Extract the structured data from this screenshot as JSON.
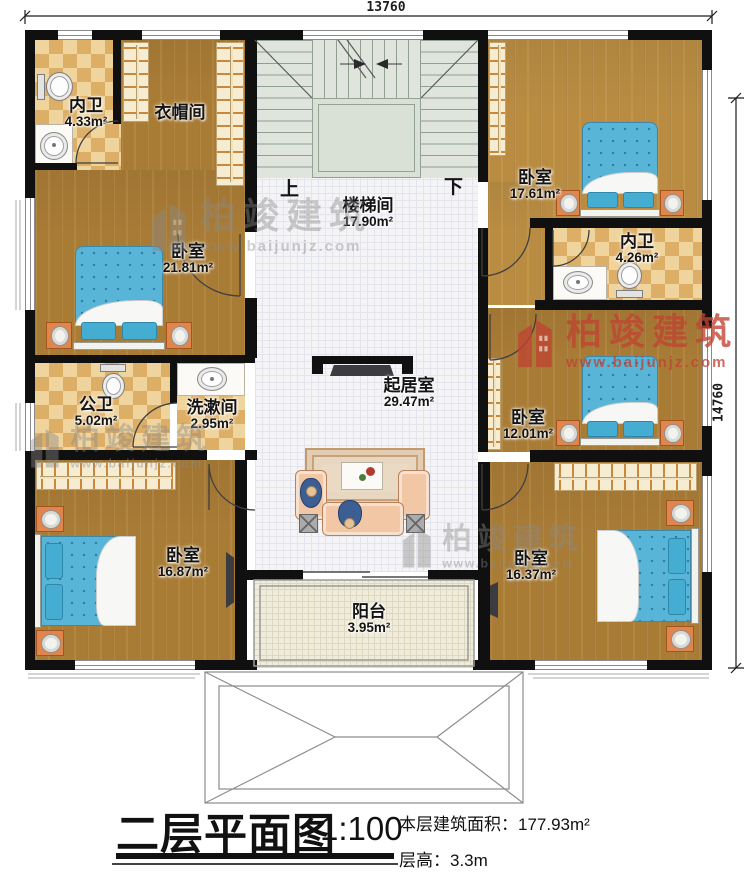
{
  "dimensions": {
    "top": "13760",
    "right": "14760"
  },
  "rooms": {
    "bath_tl": {
      "name": "内卫",
      "area": "4.33m²"
    },
    "cloakroom": {
      "name": "衣帽间"
    },
    "stair_hall": {
      "name": "楼梯间",
      "area": "17.90m²"
    },
    "bedroom_tr": {
      "name": "卧室",
      "area": "17.61m²"
    },
    "bath_r": {
      "name": "内卫",
      "area": "4.26m²"
    },
    "bedroom_ml": {
      "name": "卧室",
      "area": "21.81m²"
    },
    "public_bath": {
      "name": "公卫",
      "area": "5.02m²"
    },
    "washroom": {
      "name": "洗漱间",
      "area": "2.95m²"
    },
    "living": {
      "name": "起居室",
      "area": "29.47m²"
    },
    "bedroom_mr": {
      "name": "卧室",
      "area": "12.01m²"
    },
    "bedroom_bl": {
      "name": "卧室",
      "area": "16.87m²"
    },
    "bedroom_br": {
      "name": "卧室",
      "area": "16.37m²"
    },
    "balcony": {
      "name": "阳台",
      "area": "3.95m²"
    }
  },
  "stairs": {
    "up": "上",
    "down": "下"
  },
  "title_block": {
    "title": "二层平面图",
    "scale": "1:100",
    "area_note": "本层建筑面积：177.93m²",
    "height_note": "层高：3.3m"
  },
  "watermark": {
    "brand": "柏竣建筑",
    "url": "www.baijunjz.com"
  },
  "colors": {
    "wall": "#101010",
    "wood": "#a97c36",
    "tile_a": "#efd49d",
    "tile_b": "#ddae66",
    "stairs": "#dfe4dc",
    "grid_floor": "#f4f4f6",
    "balcony": "#efecdb",
    "bed": "#58b5d8",
    "bed_dark": "#2d7ba6",
    "pillow": "#45acd2",
    "nightstand": "#e0854b",
    "wardrobe": "#f6ecd2",
    "hanger": "#c9883c",
    "sofa": "#f2c7a6",
    "rug": "#ead9c3",
    "wm_gray": "#8a8a8a",
    "wm_red": "#c04432"
  }
}
